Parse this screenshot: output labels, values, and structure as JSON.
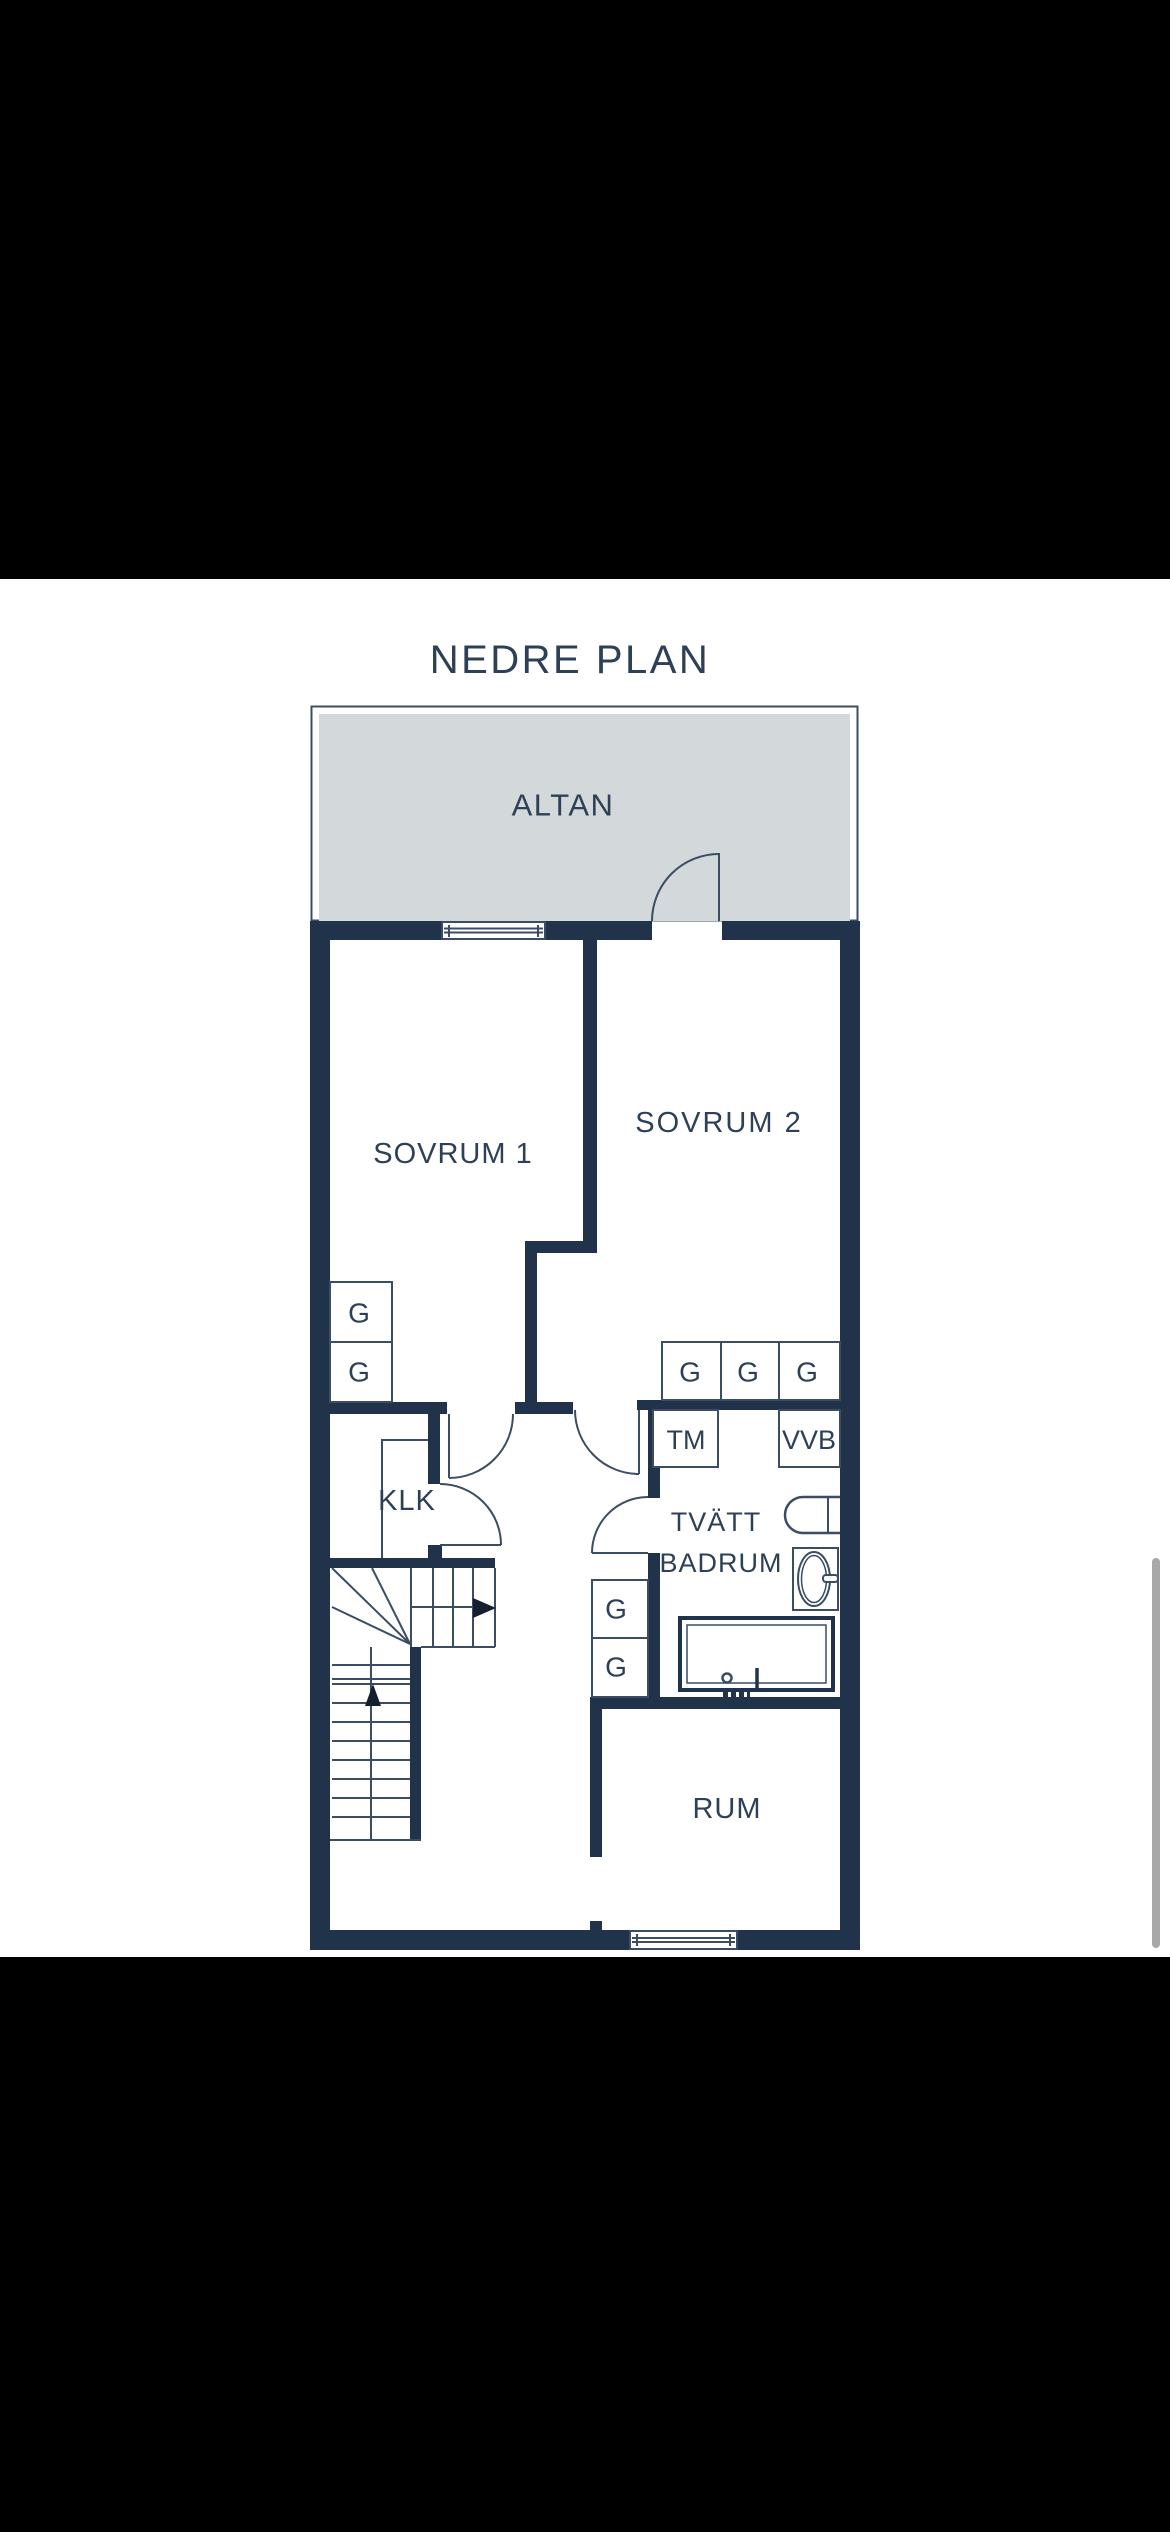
{
  "title": "NEDRE PLAN",
  "floorplan": {
    "rooms": {
      "altan": "ALTAN",
      "sovrum1": "SOVRUM 1",
      "sovrum2": "SOVRUM 2",
      "klk": "KLK",
      "tvatt_line1": "TVÄTT",
      "tvatt_line2": "BADRUM",
      "rum": "RUM"
    },
    "markers": {
      "wardrobe": "G",
      "washing_machine": "TM",
      "water_heater": "VVB"
    }
  },
  "colors": {
    "wall": "#20334a",
    "thin_line": "#3b4d63",
    "label": "#2e4057",
    "terrace_fill": "#d3d8da",
    "photo_background": "#ffffff",
    "letterbox": "#000000",
    "scrollbar": "#a8a8a8"
  }
}
